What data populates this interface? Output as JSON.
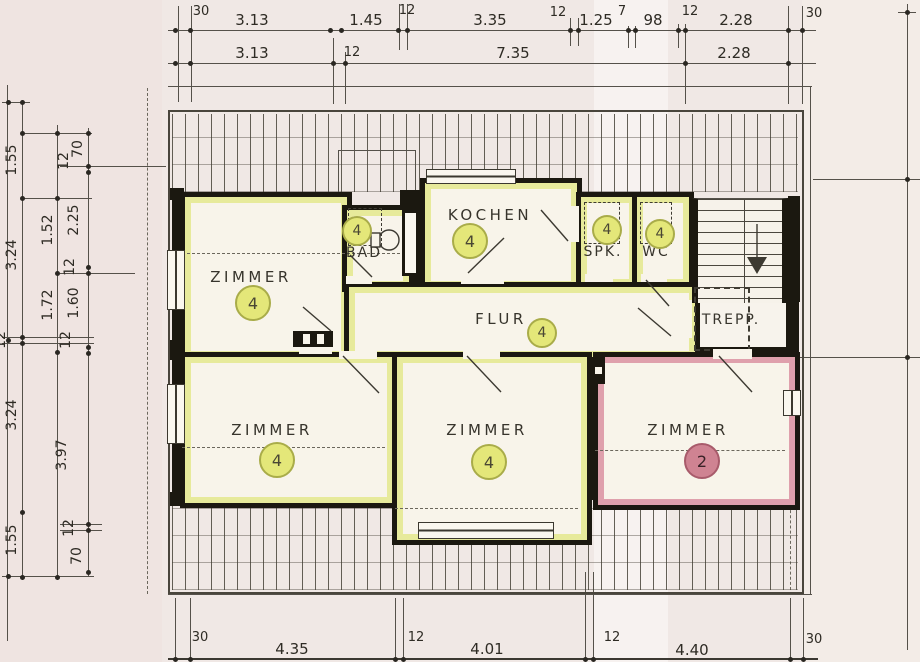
{
  "plan": {
    "type": "attic floor plan",
    "rooms": [
      {
        "label": "ZIMMER",
        "badge": "4"
      },
      {
        "label": "BAD",
        "badge": "4"
      },
      {
        "label": "KOCHEN",
        "badge": "4"
      },
      {
        "label": "SPK.",
        "badge": "4"
      },
      {
        "label": "WC",
        "badge": "4"
      },
      {
        "label": "FLUR",
        "badge": "4"
      },
      {
        "label": "TREPP."
      },
      {
        "label": "ZIMMER",
        "badge": "4"
      },
      {
        "label": "ZIMMER",
        "badge": "4"
      },
      {
        "label": "ZIMMER",
        "badge": "2"
      }
    ]
  },
  "dims": {
    "top1": [
      "30",
      "3.13",
      "1.45",
      "12",
      "3.35",
      "12",
      "1.25",
      "7",
      "98",
      "12",
      "2.28",
      "30"
    ],
    "top2": [
      "3.13",
      "12",
      "7.35",
      "2.28"
    ],
    "bottom": [
      "30",
      "4.35",
      "12",
      "4.01",
      "12",
      "4.40",
      "30"
    ],
    "left_outer": [
      "1.55",
      "3.24",
      "12",
      "3.24",
      "1.55"
    ],
    "left_mid": [
      "1.52",
      "1.72",
      "3.97"
    ],
    "left_inner": [
      "70",
      "12",
      "2.25",
      "12",
      "1.60",
      "12",
      "12",
      "70"
    ]
  },
  "colors": {
    "wall": "#1b1810",
    "paper": "#f0e8e5",
    "room_highlight_yellow": "#e7ea9b",
    "room_highlight_pink": "#dfa0ac",
    "badge_yellow_fill": "#e4e779",
    "badge_pink_fill": "#cf8392"
  }
}
